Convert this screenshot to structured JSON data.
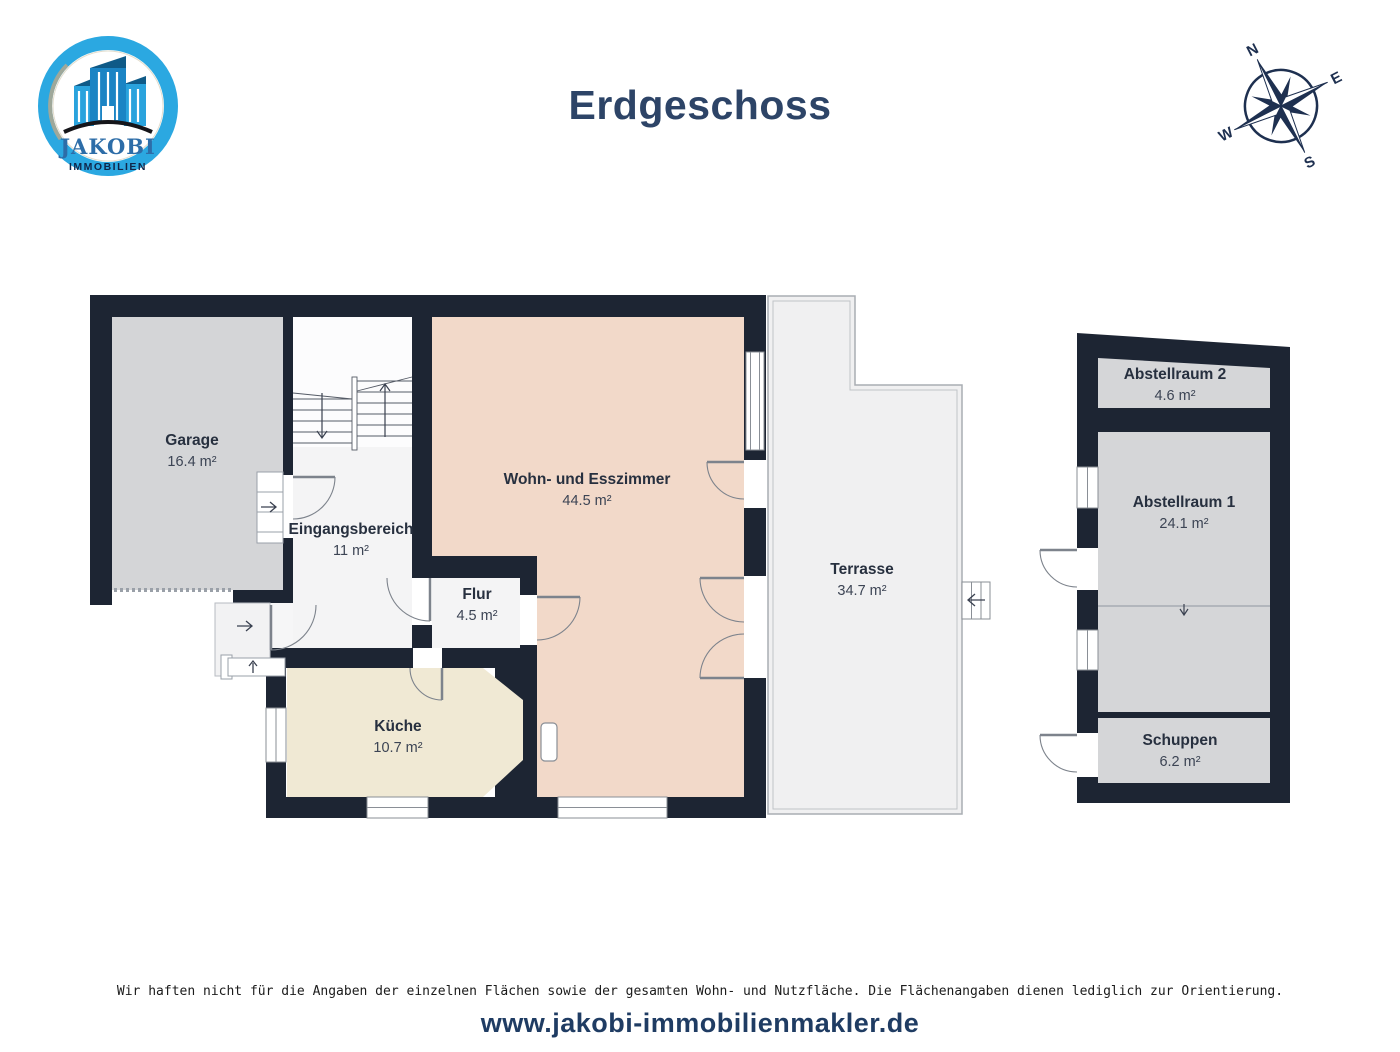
{
  "header": {
    "title": "Erdgeschoss",
    "logo": {
      "brand_display": "JAKOBI",
      "subtitle": "IMMOBILIEN"
    },
    "compass": {
      "north": "N",
      "east": "E",
      "south": "S",
      "west": "W"
    }
  },
  "floor_plan": {
    "rooms": [
      {
        "id": "garage",
        "label": "Garage",
        "area": "16.4 m²"
      },
      {
        "id": "eingangsbereich",
        "label": "Eingangsbereich",
        "area": "11 m²"
      },
      {
        "id": "wohn-esszimmer",
        "label": "Wohn- und Esszimmer",
        "area": "44.5 m²"
      },
      {
        "id": "flur",
        "label": "Flur",
        "area": "4.5 m²"
      },
      {
        "id": "kueche",
        "label": "Küche",
        "area": "10.7 m²"
      },
      {
        "id": "terrasse",
        "label": "Terrasse",
        "area": "34.7 m²"
      },
      {
        "id": "abstellraum-2",
        "label": "Abstellraum 2",
        "area": "4.6 m²"
      },
      {
        "id": "abstellraum-1",
        "label": "Abstellraum 1",
        "area": "24.1 m²"
      },
      {
        "id": "schuppen",
        "label": "Schuppen",
        "area": "6.2 m²"
      }
    ]
  },
  "footer": {
    "disclaimer": "Wir haften nicht für die Angaben der einzelnen Flächen sowie der gesamten Wohn- und Nutzfläche. Die Flächenangaben dienen lediglich zur Orientierung.",
    "website": "www.jakobi-immobilienmakler.de"
  },
  "colors": {
    "wall": "#1d2533",
    "living_room": "#f2d9c9",
    "kitchen": "#f0e9d4",
    "garage": "#d4d5d7",
    "storage": "#d5d6d8",
    "terrace": "#f0f0f1",
    "hallway": "#f4f4f5",
    "accent_navy": "#2d4467",
    "logo_blue": "#2ba8e1"
  }
}
